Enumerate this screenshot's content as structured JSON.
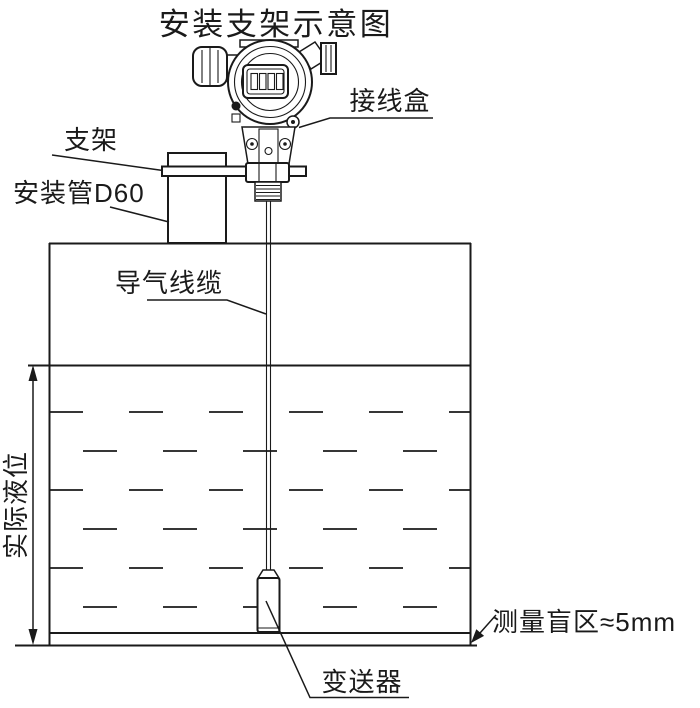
{
  "title": "安装支架示意图",
  "colors": {
    "line": "#1a1a1a",
    "background": "#ffffff"
  },
  "labels": {
    "junction_box": "接线盒",
    "bracket": "支架",
    "mounting_pipe": "安装管D60",
    "air_cable": "导气线缆",
    "actual_level": "实际液位",
    "blind_zone": "测量盲区≈5mm",
    "transmitter": "变送器"
  }
}
